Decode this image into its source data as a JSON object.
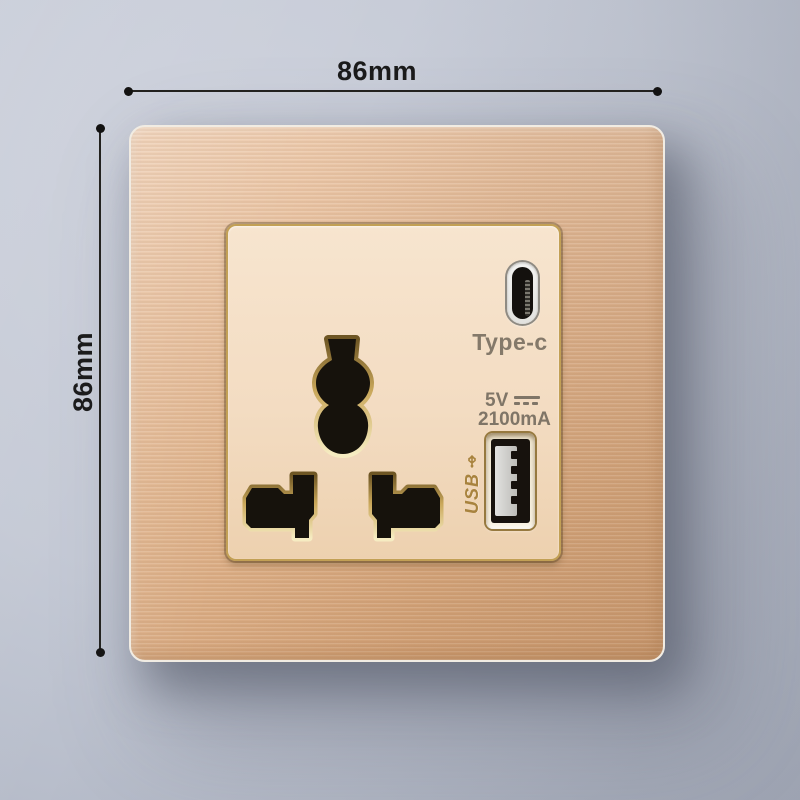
{
  "dimensions": {
    "width_label": "86mm",
    "height_label": "86mm"
  },
  "socket": {
    "typec_label": "Type-c",
    "spec_voltage": "5V",
    "spec_current": "2100mA",
    "usb_label": "USB"
  },
  "icons": {
    "dc_voltage_icon": "solid-line-over-dashed-line (IEC DC symbol)",
    "usb_trident_icon": "usb trident arrow",
    "dimension_endpoint": "filled round dot"
  },
  "colors": {
    "background_gray": "#c4c9d5",
    "plate_brushed_gold": "#e0b48c",
    "plate_edge_white": "#f1ece3",
    "panel_cream": "#f3dcc2",
    "panel_border_gold": "#c2a055",
    "hole_black": "#16120c",
    "hole_bevel_light": "#f6ecc2",
    "hole_bevel_dark": "#6e5624",
    "print_gray_brown": "#7f7567",
    "usb_print_gold": "#a8833e",
    "dimension_black": "#1b1b1b"
  }
}
